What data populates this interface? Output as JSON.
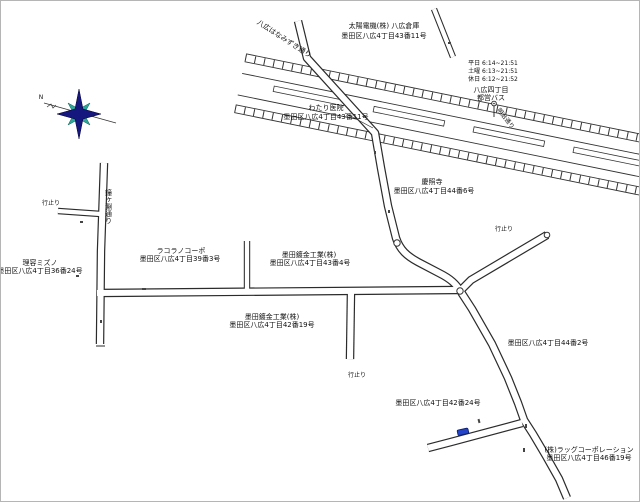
{
  "map": {
    "streets": {
      "hanamizuki": "八広はなみずき通り",
      "north_south": "鐘ヶ淵通り",
      "meiji": "明治通り"
    },
    "bus_stop": {
      "name": "八広四丁目",
      "operator": "都営バス",
      "schedule": [
        "平日 6:14~21:51",
        "土曜 6:13~21:51",
        "休日 6:12~21:52"
      ]
    },
    "places": {
      "taiyo": {
        "name": "太陽電機(株) 八広倉庫",
        "address": "墨田区八広4丁目43番11号"
      },
      "watari": {
        "name": "わたり医院",
        "address": "墨田区八広4丁目43番11号"
      },
      "temple": {
        "name": "慶照寺",
        "address": "墨田区八広4丁目44番6号"
      },
      "barber": {
        "name": "理容ミズノ",
        "address": "墨田区八広4丁目36番24号"
      },
      "corpo": {
        "name": "ラコラノコーポ",
        "address": "墨田区八広4丁目39番3号"
      },
      "sumida_mekki_1": {
        "name": "墨田鍍金工業(株)",
        "address": "墨田区八広4丁目43番4号"
      },
      "sumida_mekki_2": {
        "name": "墨田鍍金工業(株)",
        "address": "墨田区八広4丁目42番19号"
      },
      "addr_44_2": {
        "address": "墨田区八広4丁目44番2号"
      },
      "addr_42_24": {
        "address": "墨田区八広4丁目42番24号"
      },
      "rug_corp": {
        "name": "(株)ラッグコーポレーション",
        "address": "墨田区八広4丁目46番19号"
      }
    },
    "dead_end_label": "行止り",
    "compass": {
      "north_label": "N"
    },
    "icons": {
      "compass": "compass-rose-icon",
      "bus_stop": "bus-stop-pole-icon",
      "vehicle": "car-icon"
    },
    "colors": {
      "compass_primary": "#16167f",
      "compass_secondary": "#2aa89a",
      "car": "#2343c8",
      "road_line": "#2b2b2b"
    }
  }
}
